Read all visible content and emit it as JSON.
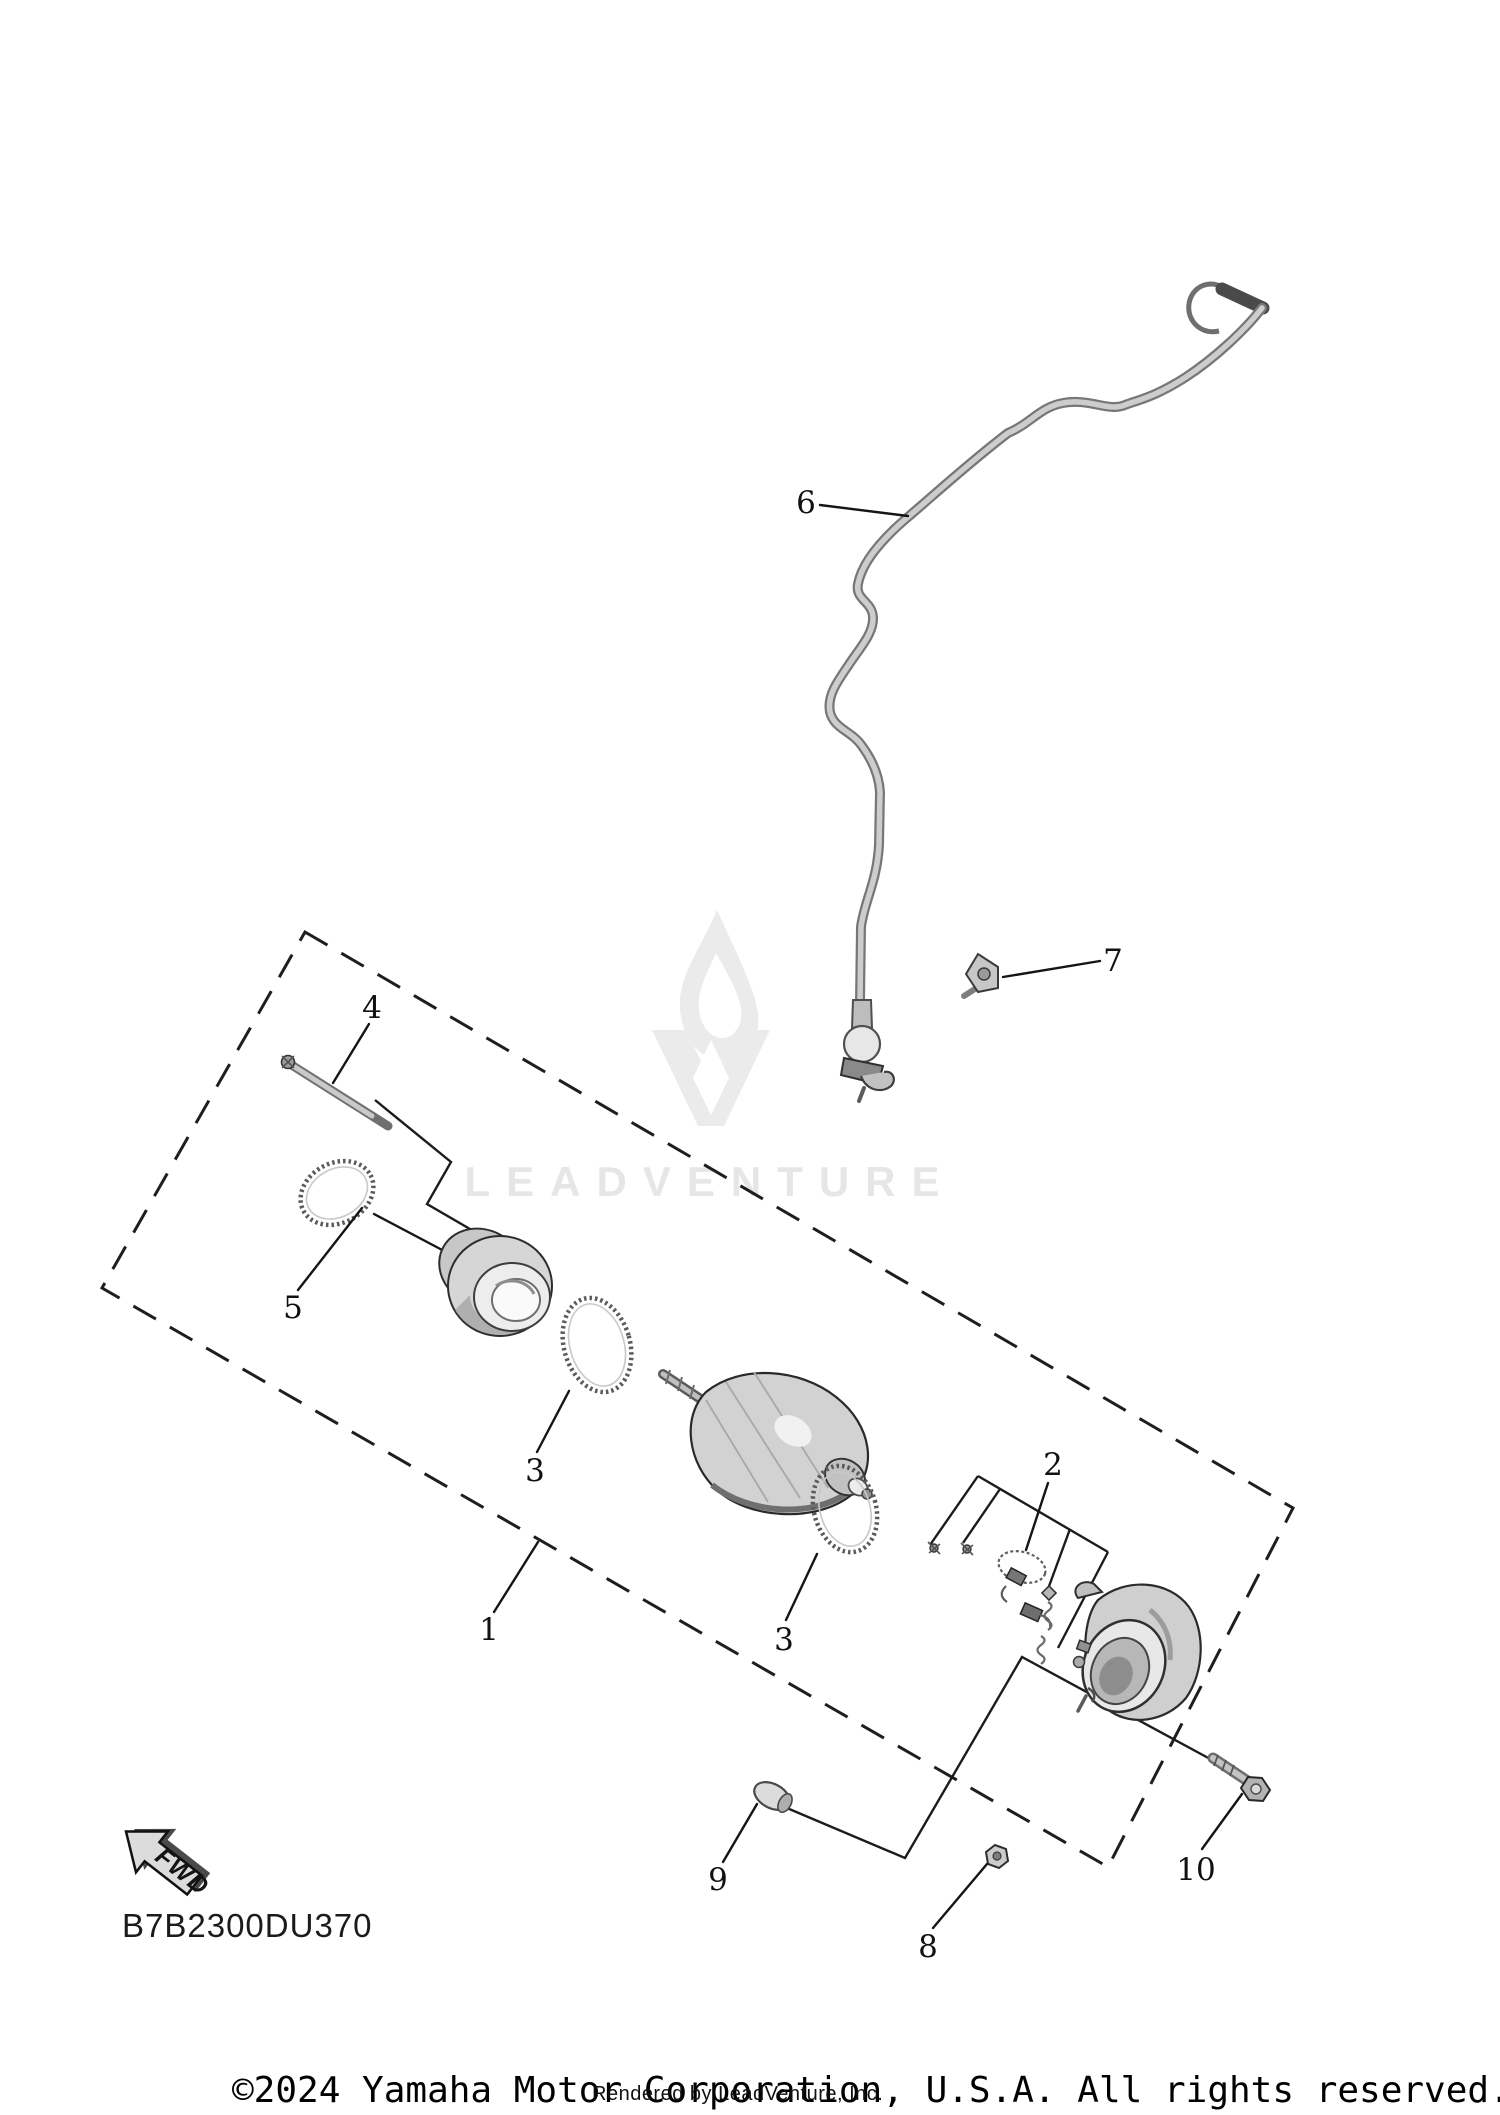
{
  "diagram": {
    "code": "B7B2300DU370",
    "orientation_label": "FWD",
    "labels": [
      {
        "text": "6"
      },
      {
        "text": "7"
      },
      {
        "text": "4"
      },
      {
        "text": "5"
      },
      {
        "text": "3"
      },
      {
        "text": "1"
      },
      {
        "text": "3"
      },
      {
        "text": "2"
      },
      {
        "text": "9"
      },
      {
        "text": "8"
      },
      {
        "text": "10"
      }
    ]
  },
  "watermark": {
    "text": "LEADVENTURE",
    "icon": "leadventure-flame-v-logo",
    "color": "#e6e6e6"
  },
  "footer": {
    "copyright": "©2024 Yamaha Motor Corporation, U.S.A. All rights reserved.",
    "rendered_by": "Rendered by LeadVenture, Inc."
  },
  "colors": {
    "background": "#ffffff",
    "line": "#1c1c1c",
    "part_fill": "#d2d2d2",
    "part_shadow": "#8f8f8f",
    "watermark": "#e6e6e6"
  }
}
